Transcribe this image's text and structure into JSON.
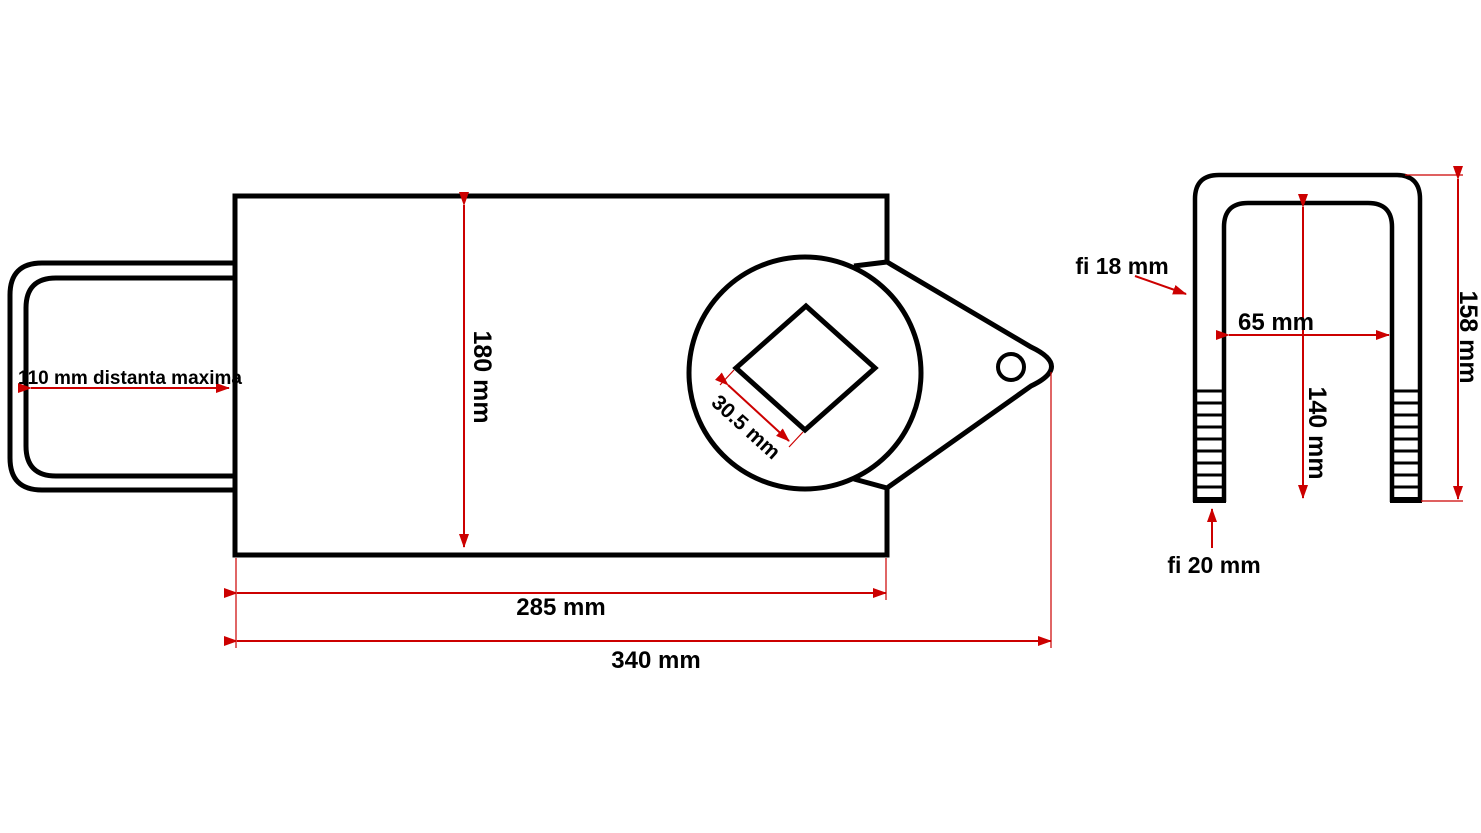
{
  "page": {
    "background": "#ffffff",
    "description": "Technical dimension drawing of a trailer coupling lock body (left view) and a threaded U-bolt (right view)"
  },
  "colors": {
    "outline": "#000000",
    "dimension": "#cc0000",
    "text": "#000000"
  },
  "coupling_lock_view": {
    "name": "coupling-lock-drawing",
    "dimensions": {
      "tongue_max_distance": "110 mm distanta maxima",
      "body_height": "180 mm",
      "square_hole_size": "30.5 mm",
      "body_length": "285 mm",
      "total_length": "340 mm"
    }
  },
  "u_bolt_view": {
    "name": "u-bolt-drawing",
    "dimensions": {
      "rod_diameter": "fi 18 mm",
      "inner_width": "65 mm",
      "inner_height": "140 mm",
      "total_height": "158 mm",
      "thread_diameter": "fi 20 mm"
    }
  }
}
